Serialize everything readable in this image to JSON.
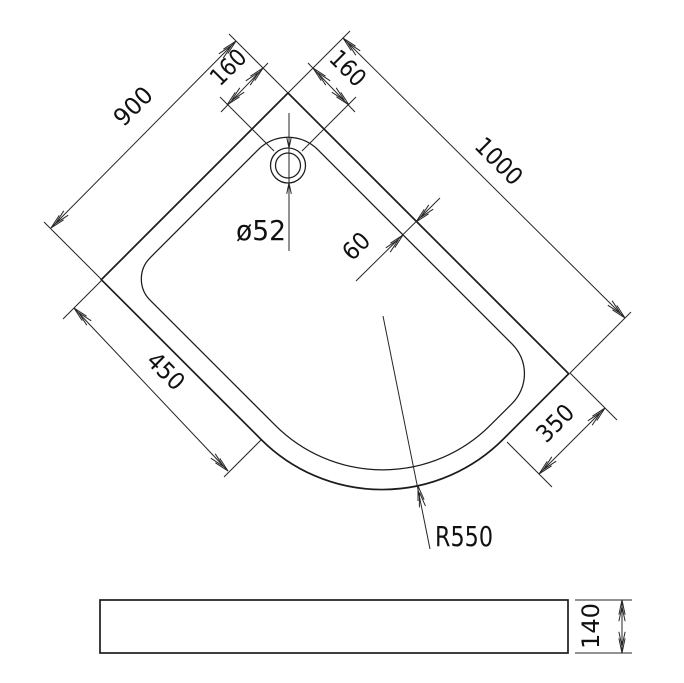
{
  "drawing": {
    "title": "offset quadrant shower tray technical drawing",
    "colors": {
      "line": "#1c1c1c",
      "background": "#ffffff"
    },
    "plan_view": {
      "dim_back_left_edge": "900",
      "dim_back_right_edge": "1000",
      "dim_drain_offset_left": "160",
      "dim_drain_offset_right": "160",
      "dim_drain_diameter": "ø52",
      "dim_rim_width": "60",
      "dim_side_left_edge": "450",
      "dim_side_right_edge": "350",
      "dim_front_radius": "R550"
    },
    "side_view": {
      "dim_height": "140"
    }
  }
}
